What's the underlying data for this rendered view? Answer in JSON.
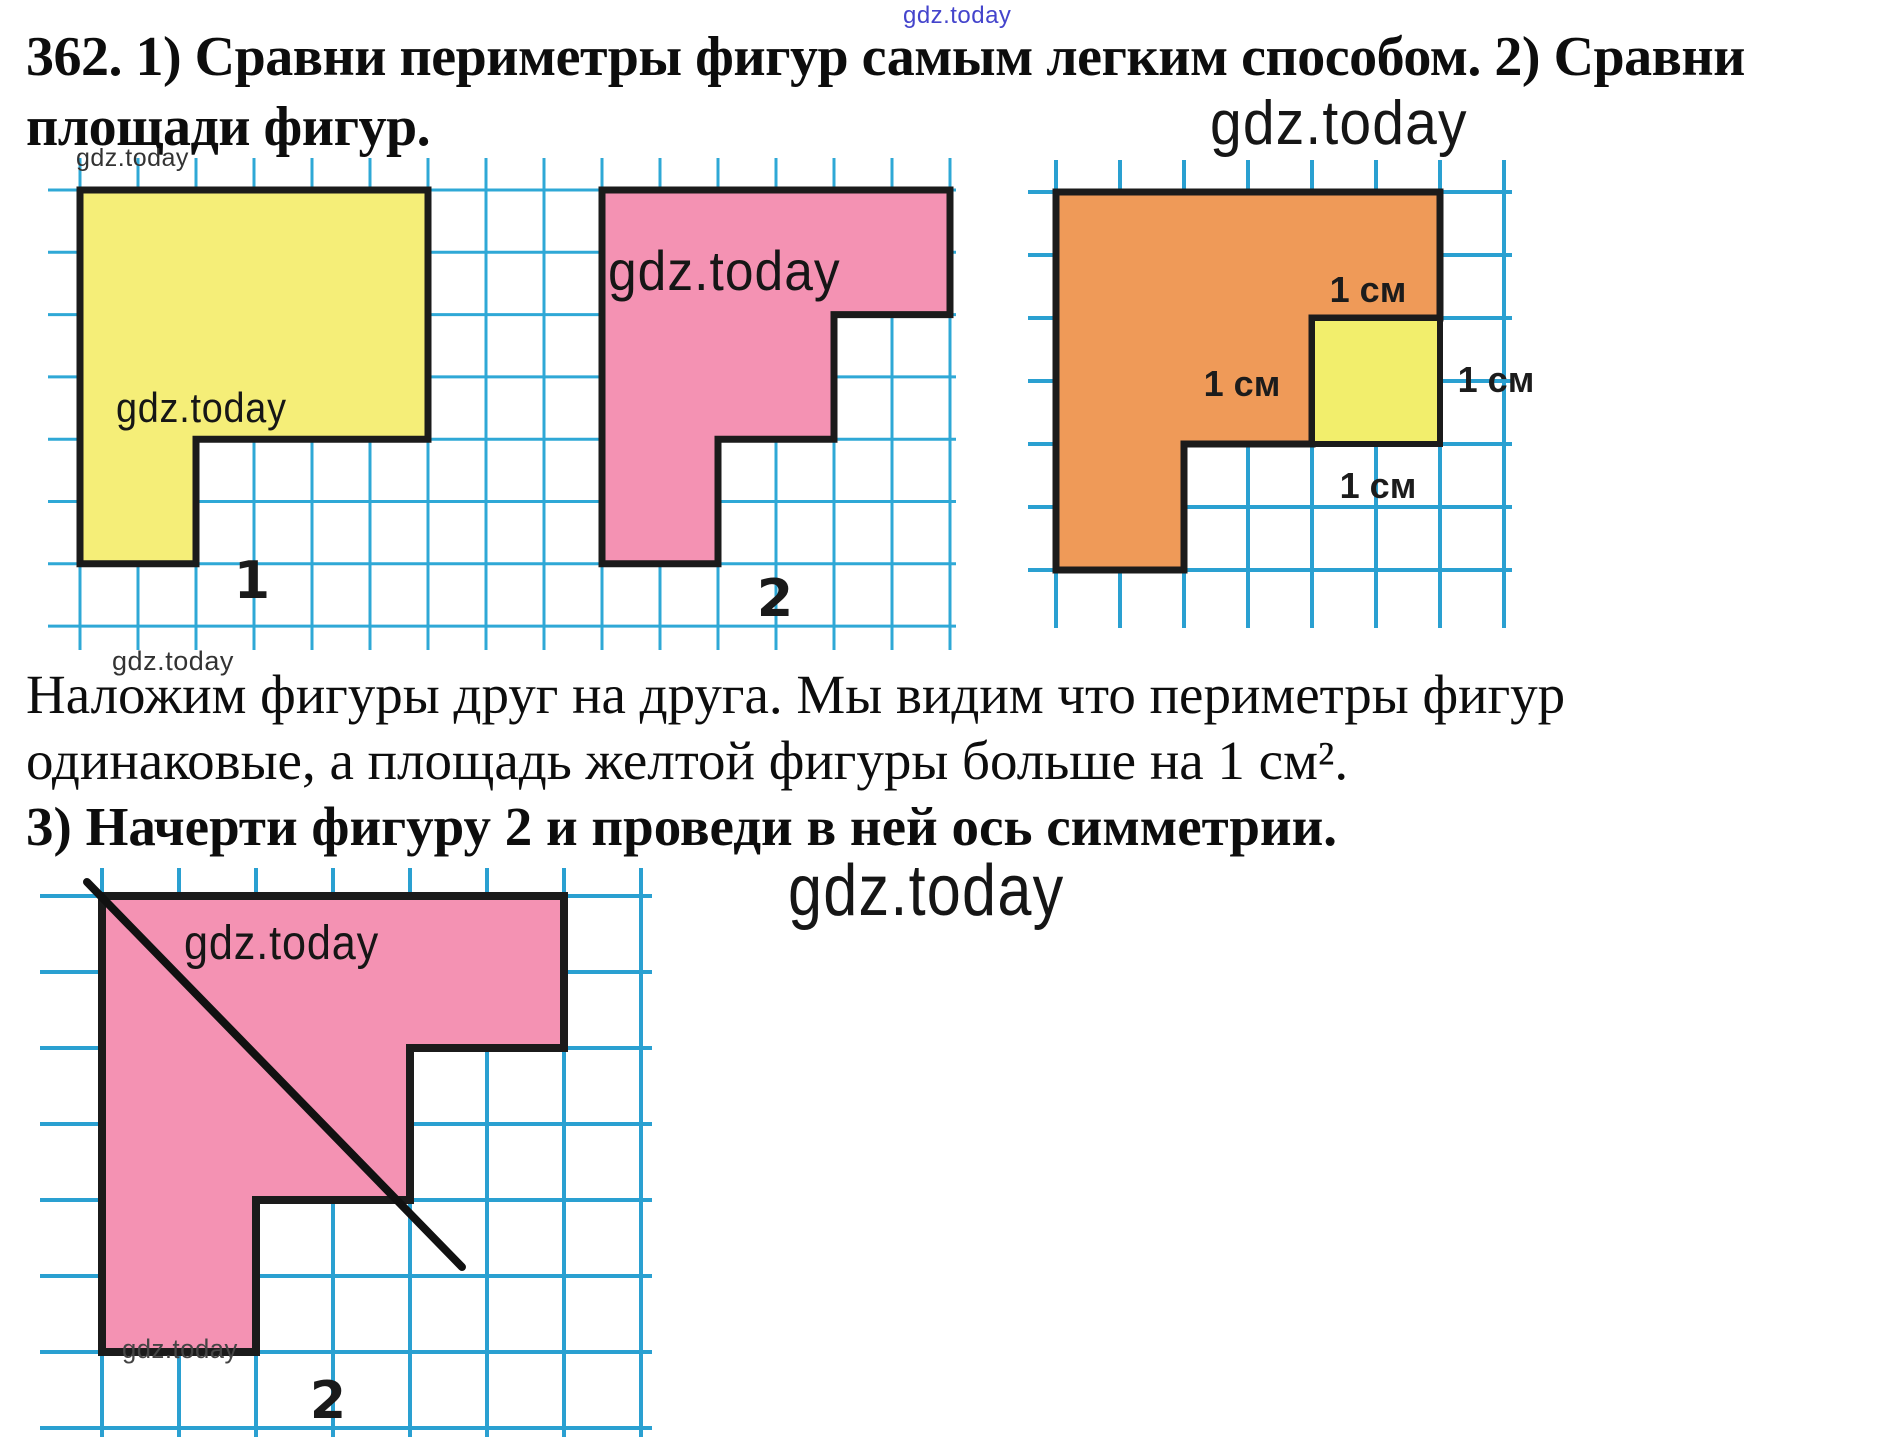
{
  "page": {
    "width": 1892,
    "height": 1437,
    "background": "#ffffff"
  },
  "title": {
    "line1": "362. 1) Сравни периметры фигур самым легким способом. 2) Сравни",
    "line2": "площади фигур."
  },
  "explanation": {
    "line1": "Наложим фигуры друг на друга. Мы видим что периметры фигур",
    "line2": "одинаковые, а площадь желтой фигуры больше на 1 см².",
    "line3": "3) Начерти фигуру 2 и проведи в ней ось симметрии."
  },
  "colors": {
    "grid_a": "#2FA8D6",
    "grid_bc": "#2AA0D1",
    "outline": "#1B1B1B",
    "yellow": "#F5EE78",
    "pink": "#F492B3",
    "orange": "#EF9A58",
    "overlap_extra_yellow": "#F2EE6C",
    "axis_line": "#111111",
    "watermark_blue": "#4444CC",
    "watermark_dark": "#161616"
  },
  "grids": [
    {
      "name": "grid-a",
      "stroke": "#2FA8D6",
      "stroke_width": 3,
      "verticals": {
        "x0": 80,
        "dx": 58,
        "n": 16,
        "y1": 158,
        "y2": 650
      },
      "horizontals": {
        "y0": 190,
        "dy": 62.3,
        "n": 8,
        "x1": 48,
        "x2": 956
      }
    },
    {
      "name": "grid-b",
      "stroke": "#2AA0D1",
      "stroke_width": 4,
      "verticals": {
        "x0": 1056,
        "dx": 64,
        "n": 8,
        "y1": 160,
        "y2": 628
      },
      "horizontals": {
        "y0": 192,
        "dy": 63,
        "n": 7,
        "x1": 1028,
        "x2": 1512
      }
    },
    {
      "name": "grid-c",
      "stroke": "#2AA0D1",
      "stroke_width": 4,
      "verticals": {
        "x0": 102,
        "dx": 77,
        "n": 8,
        "y1": 868,
        "y2": 1437
      },
      "horizontals": {
        "y0": 896,
        "dy": 76,
        "n": 8,
        "x1": 40,
        "x2": 652
      }
    }
  ],
  "figures": {
    "figure1": {
      "label": "1",
      "fill": "#F5EE78",
      "origin_px": [
        80,
        190
      ],
      "cm_px": [
        116,
        124.6
      ],
      "vertices_cm": [
        [
          0,
          0
        ],
        [
          3,
          0
        ],
        [
          3,
          2
        ],
        [
          1,
          2
        ],
        [
          1,
          3
        ],
        [
          0,
          3
        ]
      ],
      "label_pos": [
        252,
        598
      ]
    },
    "figure2": {
      "label": "2",
      "fill": "#F492B3",
      "origin_px": [
        602,
        190
      ],
      "cm_px": [
        116,
        124.6
      ],
      "vertices_cm": [
        [
          0,
          0
        ],
        [
          3,
          0
        ],
        [
          3,
          1
        ],
        [
          2,
          1
        ],
        [
          2,
          2
        ],
        [
          1,
          2
        ],
        [
          1,
          3
        ],
        [
          0,
          3
        ]
      ],
      "label_pos": [
        775,
        616
      ]
    },
    "figure3": {
      "orange_fill": "#EF9A58",
      "extra_fill": "#F2EE6C",
      "origin_px": [
        1056,
        192
      ],
      "cm_px": [
        128,
        126
      ],
      "overlap_vertices_cm": [
        [
          0,
          0
        ],
        [
          3,
          0
        ],
        [
          3,
          1
        ],
        [
          2,
          1
        ],
        [
          2,
          2
        ],
        [
          1,
          2
        ],
        [
          1,
          3
        ],
        [
          0,
          3
        ]
      ],
      "extra_square_cm": [
        2,
        1
      ],
      "dim_labels": [
        {
          "text": "1 см",
          "x": 1368,
          "y": 302
        },
        {
          "text": "1 см",
          "x": 1242,
          "y": 396
        },
        {
          "text": "1 см",
          "x": 1496,
          "y": 392
        },
        {
          "text": "1 см",
          "x": 1378,
          "y": 498
        }
      ]
    },
    "figure4": {
      "label": "2",
      "fill": "#F492B3",
      "origin_px": [
        102,
        896
      ],
      "cm_px": [
        154,
        152
      ],
      "vertices_cm": [
        [
          0,
          0
        ],
        [
          3,
          0
        ],
        [
          3,
          1
        ],
        [
          2,
          1
        ],
        [
          2,
          2
        ],
        [
          1,
          2
        ],
        [
          1,
          3
        ],
        [
          0,
          3
        ]
      ],
      "axis_line_px": [
        [
          87,
          882
        ],
        [
          462,
          1267
        ]
      ],
      "label_pos": [
        328,
        1418
      ]
    }
  },
  "watermarks": [
    {
      "text": "gdz.today",
      "x": 903,
      "y": 2,
      "size": 24,
      "color": "#4444CC",
      "sx": 1
    },
    {
      "text": "gdz.today",
      "x": 76,
      "y": 144,
      "size": 25,
      "color": "#333333",
      "sx": 1
    },
    {
      "text": "gdz.today",
      "x": 116,
      "y": 384,
      "size": 42,
      "color": "#161616",
      "sx": 0.9
    },
    {
      "text": "gdz.today",
      "x": 608,
      "y": 238,
      "size": 56,
      "color": "#161616",
      "sx": 0.92
    },
    {
      "text": "gdz.today",
      "x": 1210,
      "y": 88,
      "size": 62,
      "color": "#161616",
      "sx": 0.92
    },
    {
      "text": "gdz.today",
      "x": 112,
      "y": 646,
      "size": 27,
      "color": "#333333",
      "sx": 1
    },
    {
      "text": "gdz.today",
      "x": 184,
      "y": 916,
      "size": 48,
      "color": "#161616",
      "sx": 0.9
    },
    {
      "text": "gdz.today",
      "x": 122,
      "y": 1334,
      "size": 27,
      "color": "#444444",
      "sx": 0.95
    },
    {
      "text": "gdz.today",
      "x": 788,
      "y": 850,
      "size": 72,
      "color": "#161616",
      "sx": 0.85
    }
  ]
}
